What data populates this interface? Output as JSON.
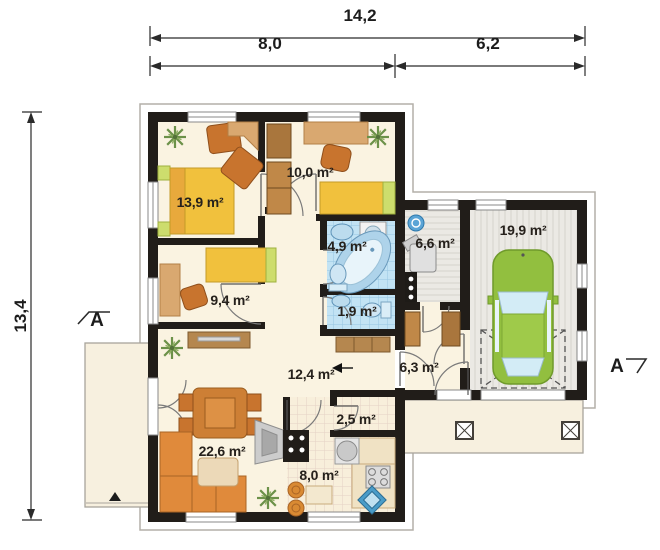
{
  "dimensions": {
    "top_total": "14,2",
    "top_left": "8,0",
    "top_right": "6,2",
    "side_left": "13,4"
  },
  "rooms": {
    "bedroom_large": {
      "area": "13,9 m²"
    },
    "bedroom_top": {
      "area": "10,0 m²"
    },
    "bathroom": {
      "area": "4,9 m²"
    },
    "utility": {
      "area": "6,6 m²"
    },
    "garage": {
      "area": "19,9 m²"
    },
    "bedroom_mid": {
      "area": "9,4 m²"
    },
    "wc": {
      "area": "1,9 m²"
    },
    "hall": {
      "area": "12,4 m²"
    },
    "vestibule": {
      "area": "6,3 m²"
    },
    "living_room": {
      "area": "22,6 m²"
    },
    "pantry": {
      "area": "2,5 m²"
    },
    "kitchen": {
      "area": "8,0 m²"
    }
  },
  "section_markers": {
    "left": "A",
    "right": "A"
  },
  "colors": {
    "wall": "#211d19",
    "floor": "#faf3e1",
    "bath_floor": "#c2e3f4",
    "garage_floor": "#ebe9e4",
    "terrace": "#f7f0df",
    "furniture_wood": "#c8742e",
    "bed_yellow": "#f1c13d",
    "car_green": "#92bf3f",
    "accent_green": "#cddd6d",
    "water_blue": "#4a9cc8"
  }
}
